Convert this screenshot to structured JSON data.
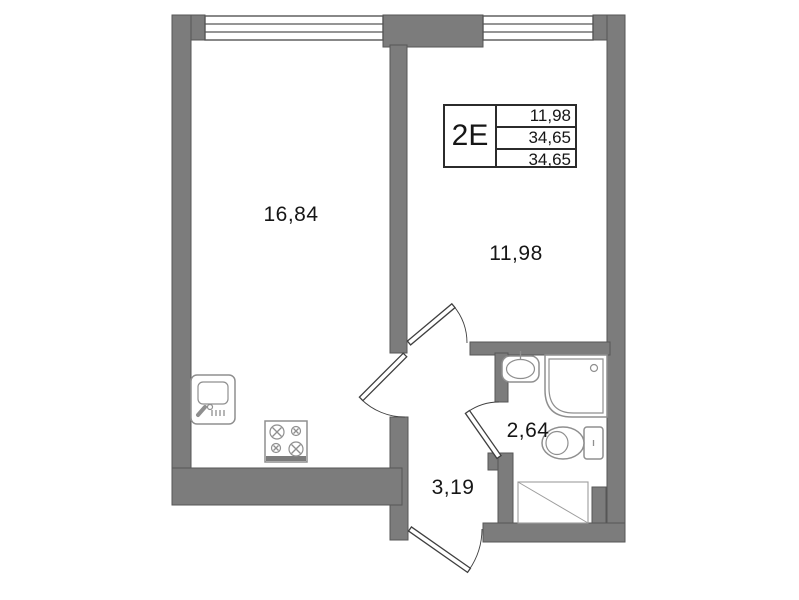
{
  "unit": {
    "type": "2E",
    "areas": [
      "11,98",
      "34,65",
      "34,65"
    ]
  },
  "rooms": {
    "living_kitchen": "16,84",
    "bedroom": "11,98",
    "bathroom": "2,64",
    "hallway": "3,19"
  },
  "colors": {
    "wall": "#7c7c7c",
    "wall_edge": "#565656",
    "door_line": "#3f3f3f",
    "fixture_line": "#8f8f8f",
    "text": "#161616",
    "background": "#ffffff"
  }
}
